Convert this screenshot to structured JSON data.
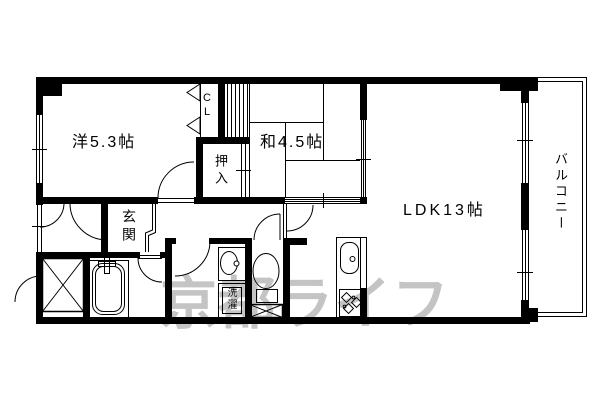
{
  "page": {
    "background": "#ffffff",
    "line_color": "#000000"
  },
  "floor_plan": {
    "rooms": {
      "western_room": {
        "label": "洋5.3帖"
      },
      "japanese_room": {
        "label": "和4.5帖"
      },
      "ldk": {
        "label": "LDK13帖"
      },
      "balcony": {
        "label": "バルコニー"
      },
      "closet": {
        "label": "CL"
      },
      "oshiire": {
        "label": "押入"
      },
      "entrance": {
        "label": "玄関"
      },
      "laundry": {
        "label": "洗濯"
      }
    },
    "fixtures": [
      "bathtub",
      "toilet",
      "washbasin",
      "kitchen-sink",
      "gas-stove",
      "meter-box",
      "pipe-space",
      "closet-bifold-doors",
      "entrance-step"
    ],
    "watermark": {
      "text": "京都ライフ",
      "color": "#c4c4c4"
    }
  }
}
